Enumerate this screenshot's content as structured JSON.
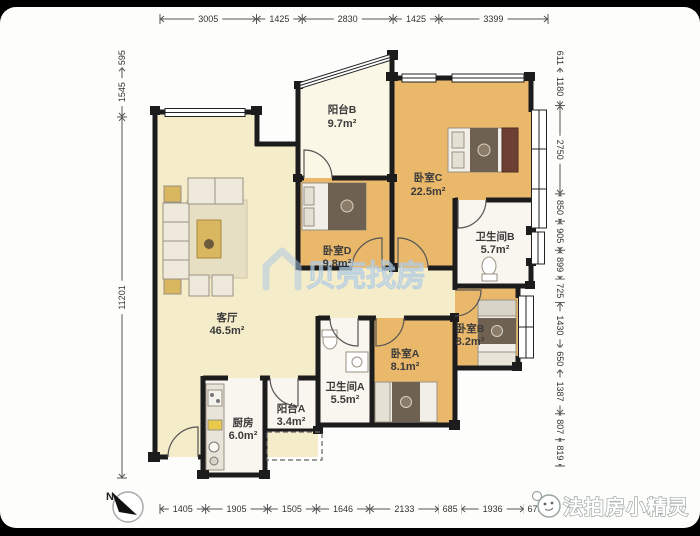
{
  "rooms": {
    "living": {
      "name": "客厅",
      "area": "46.5m²"
    },
    "bedC": {
      "name": "卧室C",
      "area": "22.5m²"
    },
    "bedD": {
      "name": "卧室D",
      "area": "9.8m²"
    },
    "bedA": {
      "name": "卧室A",
      "area": "8.1m²"
    },
    "bedB": {
      "name": "卧室B",
      "area": "8.2m²"
    },
    "bathA": {
      "name": "卫生间A",
      "area": "5.5m²"
    },
    "bathB": {
      "name": "卫生间B",
      "area": "5.7m²"
    },
    "balconyA": {
      "name": "阳台A",
      "area": "3.4m²"
    },
    "balconyB": {
      "name": "阳台B",
      "area": "9.7m²"
    },
    "kitchen": {
      "name": "厨房",
      "area": "6.0m²"
    }
  },
  "dimensions": {
    "top": [
      "3005",
      "1425",
      "2830",
      "1425",
      "3399"
    ],
    "bottom": [
      "1405",
      "1905",
      "1505",
      "1646",
      "2133",
      "685",
      "1936",
      "675"
    ],
    "left": [
      "595",
      "1545",
      "11201"
    ],
    "right": [
      "611",
      "1180",
      "2750",
      "850",
      "905",
      "899",
      "725",
      "1430",
      "650",
      "1387",
      "807",
      "819"
    ]
  },
  "compass": {
    "label": "N"
  },
  "watermark": {
    "text": "贝壳找房"
  },
  "logo": {
    "text": "法拍房小精灵"
  },
  "colors": {
    "wall": "#1c1c1c",
    "wood_floor": "#eab86b",
    "cream_floor": "#f5ecca",
    "white_floor": "#f8f6ee",
    "balcony_floor": "#faf7e6",
    "watermark_blue": "#a9c7e2"
  }
}
